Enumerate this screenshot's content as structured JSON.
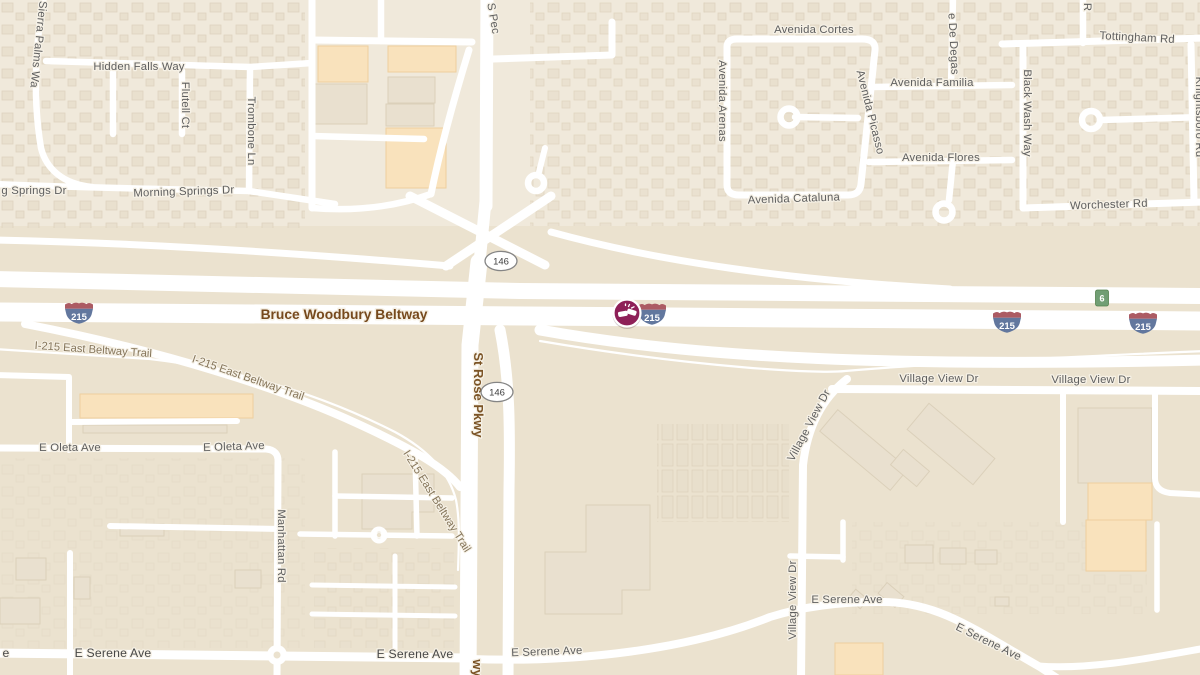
{
  "map": {
    "description": "road-map",
    "colors": {
      "land_north": "#F0E9DB",
      "land_south": "#EBE2CF",
      "road": "#FFFFFF",
      "building": "#E9E0CF",
      "building_commercial": "#F9E2BC",
      "incident": "#8E2058",
      "interstate_blue": "#62779E",
      "interstate_red": "#AC5B63",
      "exit_green": "#719E74",
      "label_gray": "#5E5E5E",
      "label_highway_brown": "#76491C",
      "label_trail": "#85755A"
    },
    "road_labels": [
      {
        "text": "Sierra Palms Wa",
        "x": 35,
        "y": 44,
        "r": 96,
        "s": "street"
      },
      {
        "text": "Hidden Falls Way",
        "x": 139,
        "y": 70,
        "r": 0,
        "s": "street"
      },
      {
        "text": "Flutell Ct",
        "x": 182,
        "y": 105,
        "r": 90,
        "s": "street"
      },
      {
        "text": "Trombone Ln",
        "x": 248,
        "y": 131,
        "r": 90,
        "s": "street"
      },
      {
        "text": "g Springs Dr",
        "x": 34,
        "y": 194,
        "r": 0,
        "s": "street"
      },
      {
        "text": "Morning Springs Dr",
        "x": 184,
        "y": 195,
        "r": -2,
        "s": "street"
      },
      {
        "text": "S Pec",
        "x": 490,
        "y": 19,
        "r": 80,
        "s": "street"
      },
      {
        "text": "Avenida Cortes",
        "x": 814,
        "y": 33,
        "r": 0,
        "s": "street"
      },
      {
        "text": "Avenida Arenas",
        "x": 719,
        "y": 101,
        "r": 90,
        "s": "street"
      },
      {
        "text": "Avenida Picasso",
        "x": 867,
        "y": 113,
        "r": 76,
        "s": "street"
      },
      {
        "text": "e De Degas",
        "x": 950,
        "y": 44,
        "r": 87,
        "s": "street"
      },
      {
        "text": "Avenida Familia",
        "x": 932,
        "y": 86,
        "r": 0,
        "s": "street"
      },
      {
        "text": "Avenida Flores",
        "x": 941,
        "y": 161,
        "r": 0,
        "s": "street"
      },
      {
        "text": "Avenida Cataluna",
        "x": 794,
        "y": 202,
        "r": -2,
        "s": "street"
      },
      {
        "text": "Tottingham Rd",
        "x": 1137,
        "y": 41,
        "r": 3,
        "s": "street"
      },
      {
        "text": "R",
        "x": 1084,
        "y": 7,
        "r": 90,
        "s": "street"
      },
      {
        "text": "Black Wash Way",
        "x": 1024,
        "y": 113,
        "r": 90,
        "s": "street"
      },
      {
        "text": "Worchester Rd",
        "x": 1109,
        "y": 208,
        "r": -2,
        "s": "street"
      },
      {
        "text": "Knightsboro Rd",
        "x": 1196,
        "y": 117,
        "r": 90,
        "s": "street"
      },
      {
        "text": "Bruce Woodbury Beltway",
        "x": 344,
        "y": 319,
        "r": 0,
        "s": "highway"
      },
      {
        "text": "I-215 East Beltway Trail",
        "x": 93,
        "y": 353,
        "r": 4,
        "s": "trail"
      },
      {
        "text": "I-215 East Beltway Trail",
        "x": 247,
        "y": 381,
        "r": 19,
        "s": "trail"
      },
      {
        "text": "I-215 East Beltway Trail",
        "x": 434,
        "y": 503,
        "r": 58,
        "s": "trail"
      },
      {
        "text": "St Rose Pkwy",
        "x": 474,
        "y": 395,
        "r": 90,
        "s": "highway-sm"
      },
      {
        "text": "wy",
        "x": 473,
        "y": 668,
        "r": 90,
        "s": "highway-sm"
      },
      {
        "text": "E Oleta Ave",
        "x": 70,
        "y": 451,
        "r": 0,
        "s": "street"
      },
      {
        "text": "E Oleta Ave",
        "x": 234,
        "y": 450,
        "r": -2,
        "s": "street"
      },
      {
        "text": "Manhattan Rd",
        "x": 278,
        "y": 546,
        "r": 90,
        "s": "street"
      },
      {
        "text": "e",
        "x": 6,
        "y": 657,
        "r": 0,
        "s": "street-bold"
      },
      {
        "text": "E Serene Ave",
        "x": 113,
        "y": 657,
        "r": 0,
        "s": "street-bold"
      },
      {
        "text": "E Serene Ave",
        "x": 415,
        "y": 658,
        "r": 0,
        "s": "street-bold"
      },
      {
        "text": "E Serene Ave",
        "x": 547,
        "y": 655,
        "r": -2,
        "s": "street"
      },
      {
        "text": "E Serene Ave",
        "x": 847,
        "y": 603,
        "r": 0,
        "s": "street"
      },
      {
        "text": "E Serene Ave",
        "x": 987,
        "y": 645,
        "r": 26,
        "s": "street"
      },
      {
        "text": "Village View Dr",
        "x": 812,
        "y": 427,
        "r": -62,
        "s": "street"
      },
      {
        "text": "Village View Dr",
        "x": 939,
        "y": 382,
        "r": 0,
        "s": "street"
      },
      {
        "text": "Village View Dr",
        "x": 1091,
        "y": 383,
        "r": 0,
        "s": "street"
      },
      {
        "text": "Village View Dr",
        "x": 796,
        "y": 600,
        "r": -90,
        "s": "street"
      }
    ],
    "shields": {
      "interstate": {
        "label": "215",
        "positions": [
          [
            79,
            313
          ],
          [
            652,
            314
          ],
          [
            1007,
            322
          ],
          [
            1143,
            323
          ]
        ]
      },
      "state_route": {
        "label": "146",
        "positions": [
          [
            501,
            261
          ],
          [
            497,
            392
          ]
        ]
      },
      "exit_badge": {
        "label": "6",
        "position": [
          1102,
          298
        ]
      }
    },
    "incident": {
      "kind": "car-crash",
      "position": [
        627,
        313
      ]
    }
  }
}
